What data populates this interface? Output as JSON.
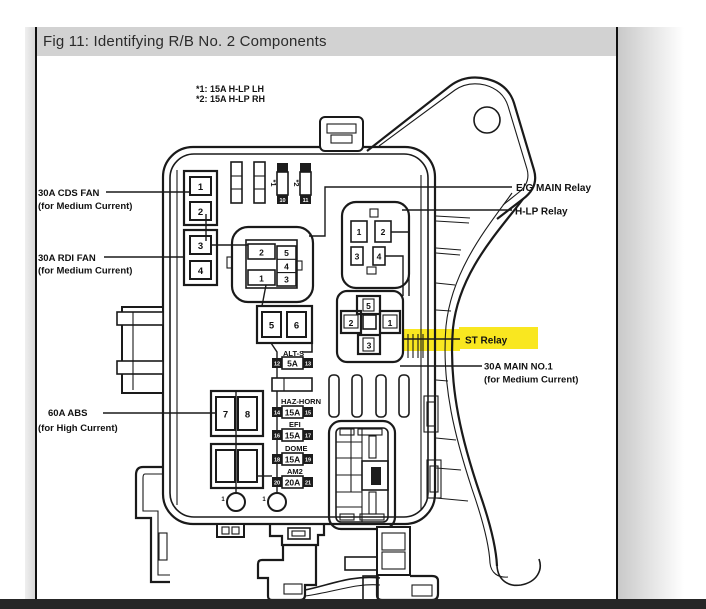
{
  "page": {
    "title": "Fig 11: Identifying R/B No. 2 Components"
  },
  "notes": [
    "*1: 15A H-LP LH",
    "*2: 15A H-LP RH"
  ],
  "markers": [
    "*1",
    "*2"
  ],
  "callouts": {
    "cds_fan": [
      "30A CDS FAN",
      "(for Medium Current)"
    ],
    "rdi_fan": [
      "30A RDI FAN",
      "(for Medium Current)"
    ],
    "abs": [
      "60A ABS",
      "(for High Current)"
    ],
    "eg_main": "E/G MAIN Relay",
    "hlp": "H-LP Relay",
    "st": "ST Relay",
    "main_no1": [
      "30A MAIN NO.1",
      "(for Medium Current)"
    ]
  },
  "slots": {
    "cds": [
      "1",
      "2"
    ],
    "rdi": [
      "3",
      "4"
    ],
    "abs": [
      "7",
      "8"
    ],
    "mid": [
      "5",
      "6"
    ],
    "top_pins": [
      "10",
      "11"
    ],
    "ground_pins": [
      "1",
      "1"
    ]
  },
  "eg_connector": {
    "top": "2",
    "bottom": "1",
    "column": [
      "5",
      "4",
      "3"
    ]
  },
  "hlp_relay": [
    "1",
    "2",
    "3",
    "4"
  ],
  "st_relay": {
    "top": "5",
    "left": "2",
    "right": "1",
    "bottom": "3"
  },
  "fuses": [
    {
      "name": "ALT-S",
      "amps": "5A",
      "pins": [
        "12",
        "13"
      ]
    },
    {
      "name": "HAZ-HORN",
      "amps": "15A",
      "pins": [
        "14",
        "15"
      ]
    },
    {
      "name": "EFI",
      "amps": "15A",
      "pins": [
        "16",
        "17"
      ]
    },
    {
      "name": "DOME",
      "amps": "15A",
      "pins": [
        "18",
        "19"
      ]
    },
    {
      "name": "AM2",
      "amps": "20A",
      "pins": [
        "20",
        "21"
      ]
    }
  ],
  "colors": {
    "highlight": "#f9e720",
    "line": "#1a1a1a",
    "header_bg": "#d2d2d2"
  }
}
